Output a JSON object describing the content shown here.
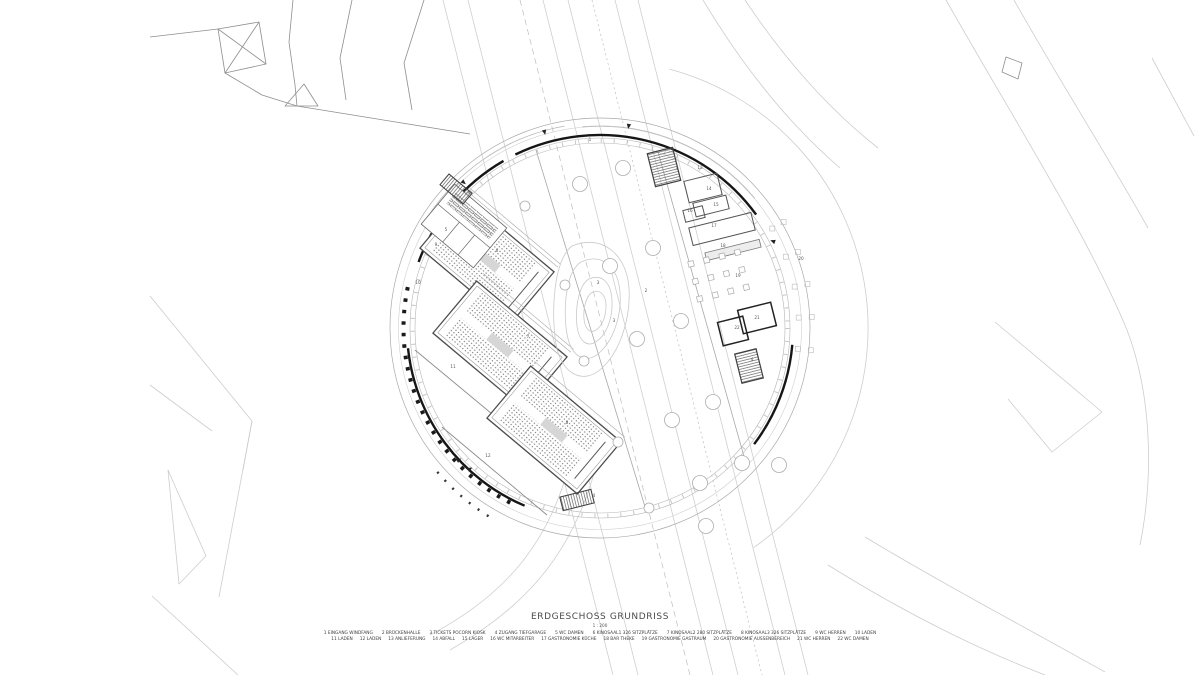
{
  "document": {
    "title": "ERDGESCHOSS GRUNDRISS",
    "scale": "1 : 200"
  },
  "legend": {
    "row1": [
      {
        "num": "1",
        "label": "EINGANG WINDFANG"
      },
      {
        "num": "2",
        "label": "BRÜCKENHALLE"
      },
      {
        "num": "3",
        "label": "TICKETS POCORN KIOSK"
      },
      {
        "num": "4",
        "label": "ZUGANG TIEFGARAGE"
      },
      {
        "num": "5",
        "label": "WC DAMEN"
      },
      {
        "num": "6",
        "label": "KINOSAAL1 326 SITZPLÄTZE"
      },
      {
        "num": "7",
        "label": "KINOSAAL2 280 SITZPLÄTZE"
      },
      {
        "num": "8",
        "label": "KINOSAAL3 326 SITZPLÄTZE"
      },
      {
        "num": "9",
        "label": "WC HERREN"
      },
      {
        "num": "10",
        "label": "LADEN"
      }
    ],
    "row2": [
      {
        "num": "11",
        "label": "LADEN"
      },
      {
        "num": "12",
        "label": "LADEN"
      },
      {
        "num": "13",
        "label": "ANLIEFERUNG"
      },
      {
        "num": "14",
        "label": "ABFALL"
      },
      {
        "num": "15",
        "label": "LAGER"
      },
      {
        "num": "16",
        "label": "WC MITARBEITER"
      },
      {
        "num": "17",
        "label": "GASTRONOMIE KÜCHE"
      },
      {
        "num": "18",
        "label": "BAR THEKE"
      },
      {
        "num": "19",
        "label": "GASTRONOMIE GASTRAUM"
      },
      {
        "num": "20",
        "label": "GASTRONOMIE AUSSENBEREICH"
      },
      {
        "num": "21",
        "label": "WC HERREN"
      },
      {
        "num": "22",
        "label": "WC DAMEN"
      }
    ]
  },
  "plan": {
    "colors": {
      "paper": "#ffffff",
      "ink_heavy": "#161616",
      "ink": "#4a4a4a",
      "ink_light": "#c8c8c8"
    },
    "room_labels": [
      {
        "n": "1",
        "x": 590,
        "y": 141
      },
      {
        "n": "2",
        "x": 646,
        "y": 292
      },
      {
        "n": "3",
        "x": 598,
        "y": 284
      },
      {
        "n": "3",
        "x": 614,
        "y": 322
      },
      {
        "n": "4",
        "x": 469,
        "y": 194
      },
      {
        "n": "4",
        "x": 677,
        "y": 170
      },
      {
        "n": "4",
        "x": 752,
        "y": 361
      },
      {
        "n": "4",
        "x": 594,
        "y": 497
      },
      {
        "n": "5",
        "x": 446,
        "y": 231
      },
      {
        "n": "6",
        "x": 497,
        "y": 252
      },
      {
        "n": "7",
        "x": 528,
        "y": 338
      },
      {
        "n": "8",
        "x": 567,
        "y": 424
      },
      {
        "n": "9",
        "x": 436,
        "y": 246
      },
      {
        "n": "10",
        "x": 418,
        "y": 284
      },
      {
        "n": "11",
        "x": 453,
        "y": 368
      },
      {
        "n": "12",
        "x": 488,
        "y": 457
      },
      {
        "n": "13",
        "x": 700,
        "y": 169
      },
      {
        "n": "14",
        "x": 709,
        "y": 190
      },
      {
        "n": "15",
        "x": 716,
        "y": 206
      },
      {
        "n": "16",
        "x": 690,
        "y": 212
      },
      {
        "n": "17",
        "x": 714,
        "y": 227
      },
      {
        "n": "18",
        "x": 723,
        "y": 247
      },
      {
        "n": "19",
        "x": 738,
        "y": 277
      },
      {
        "n": "20",
        "x": 801,
        "y": 260
      },
      {
        "n": "21",
        "x": 757,
        "y": 319
      },
      {
        "n": "22",
        "x": 737,
        "y": 329
      }
    ]
  }
}
